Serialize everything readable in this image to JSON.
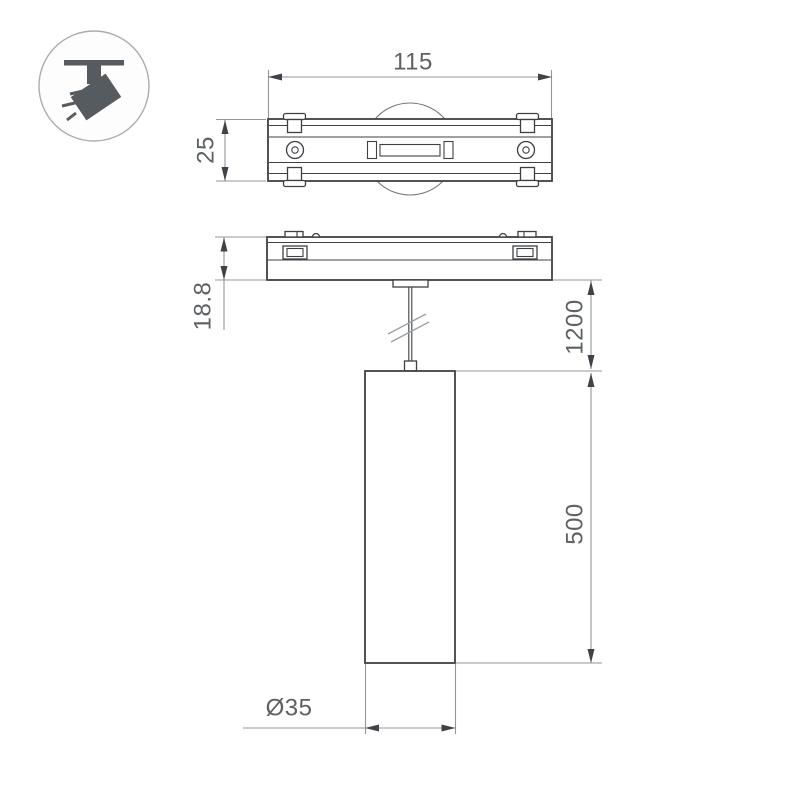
{
  "colors": {
    "background": "#ffffff",
    "outline": "#3d4144",
    "dimension_line": "#929699",
    "arrow": "#3f4348",
    "dimension_text": "#5d6164",
    "icon_glyph": "#565b5f",
    "icon_circle_stroke": "#a9adb0"
  },
  "icon": {
    "name": "suspended-track-spotlight-icon"
  },
  "dimensions": {
    "track_width": "115",
    "track_depth": "25",
    "adapter_height": "18.8",
    "suspension_length": "1200",
    "body_height": "500",
    "body_diameter": "Ø35"
  }
}
